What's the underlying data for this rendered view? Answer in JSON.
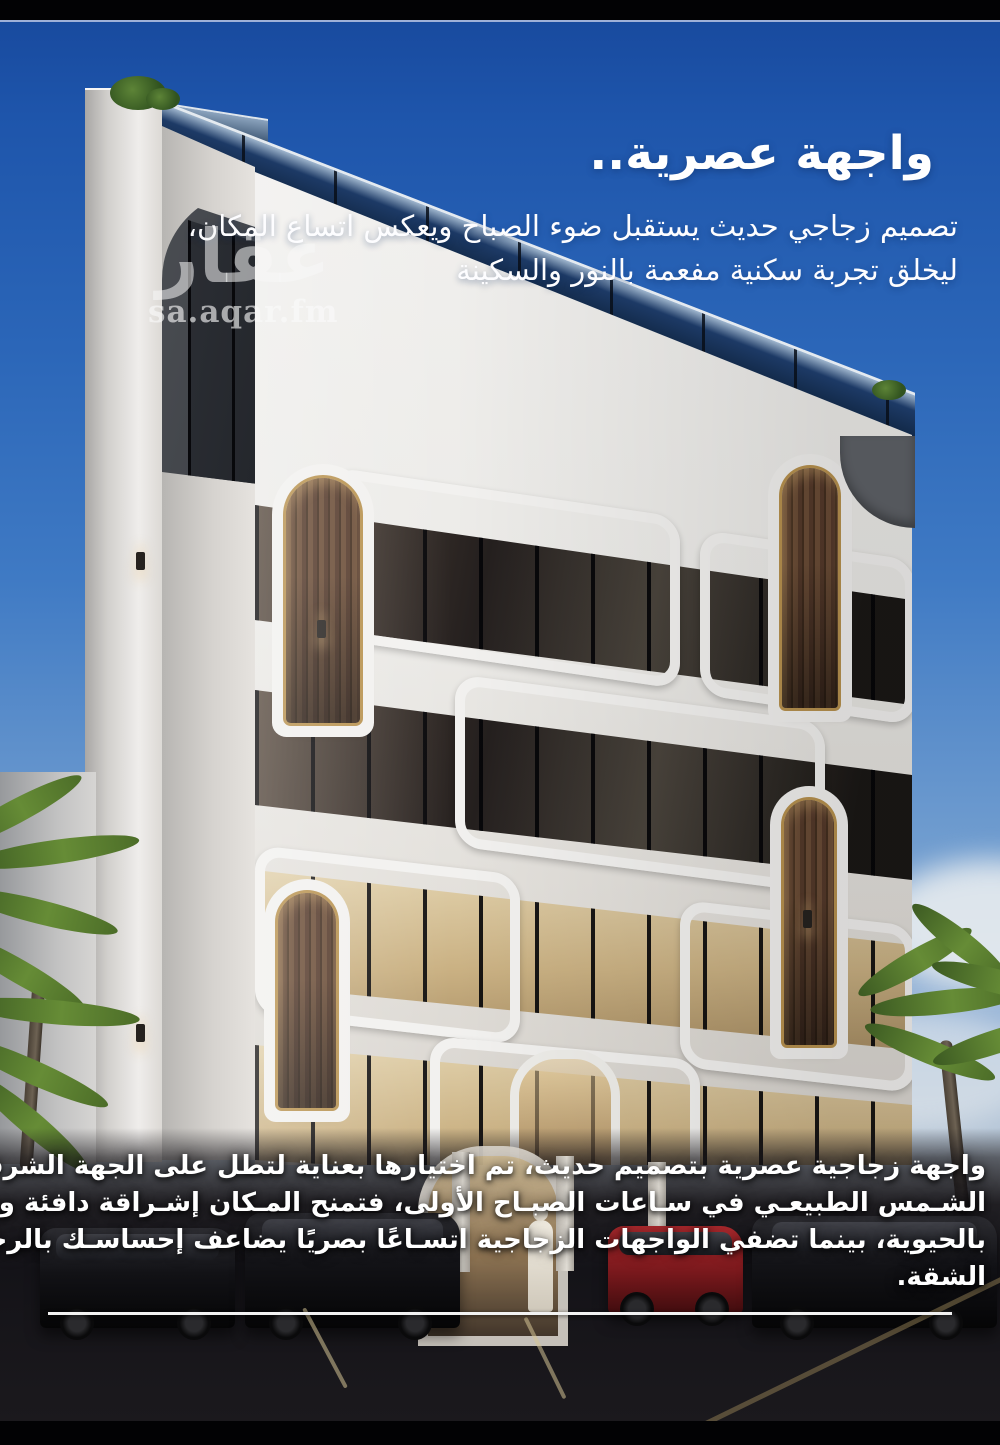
{
  "page": {
    "type": "real-estate-promo",
    "language": "ar"
  },
  "header": {
    "title": "واجهة عصرية..",
    "subtitle_lines": [
      "تصميم زجاجي حديث يستقبل ضوء الصباح ويعكس اتساع المكان،",
      "ليخلق تجربة سكنية مفعمة بالنور والسكينة"
    ]
  },
  "watermark": {
    "logo": "عقار",
    "url": "sa.aqar.fm"
  },
  "description": {
    "lines": [
      "واجهة زجاجية عصرية بتصميم حديث، تم اختيارها بعناية لتطل على الجهة الشرقية وتستفيد من ضوء",
      "الشـمس الطبيعـي في سـاعات الصبـاح الأولى، فتمنح المـكان إشـراقة دافئة وبداية يـوم مليئة",
      "بالحيوية، بينما تضفي الواجهات الزجاجية اتسـاعًا بصريًا يضاعف إحساسـك بالرحابة والانفتاح داخل",
      "الشقة."
    ]
  },
  "colors": {
    "sky_top": "#17489c",
    "sky_horizon": "#d9d8d4",
    "text": "#ffffff",
    "wood": "#5d4431",
    "gold_trim": "#b8924f",
    "glass_dark": "#1b1c20",
    "glass_warm": "#cab183",
    "facade_white": "#f1f0ee",
    "bar_black": "#020204"
  }
}
